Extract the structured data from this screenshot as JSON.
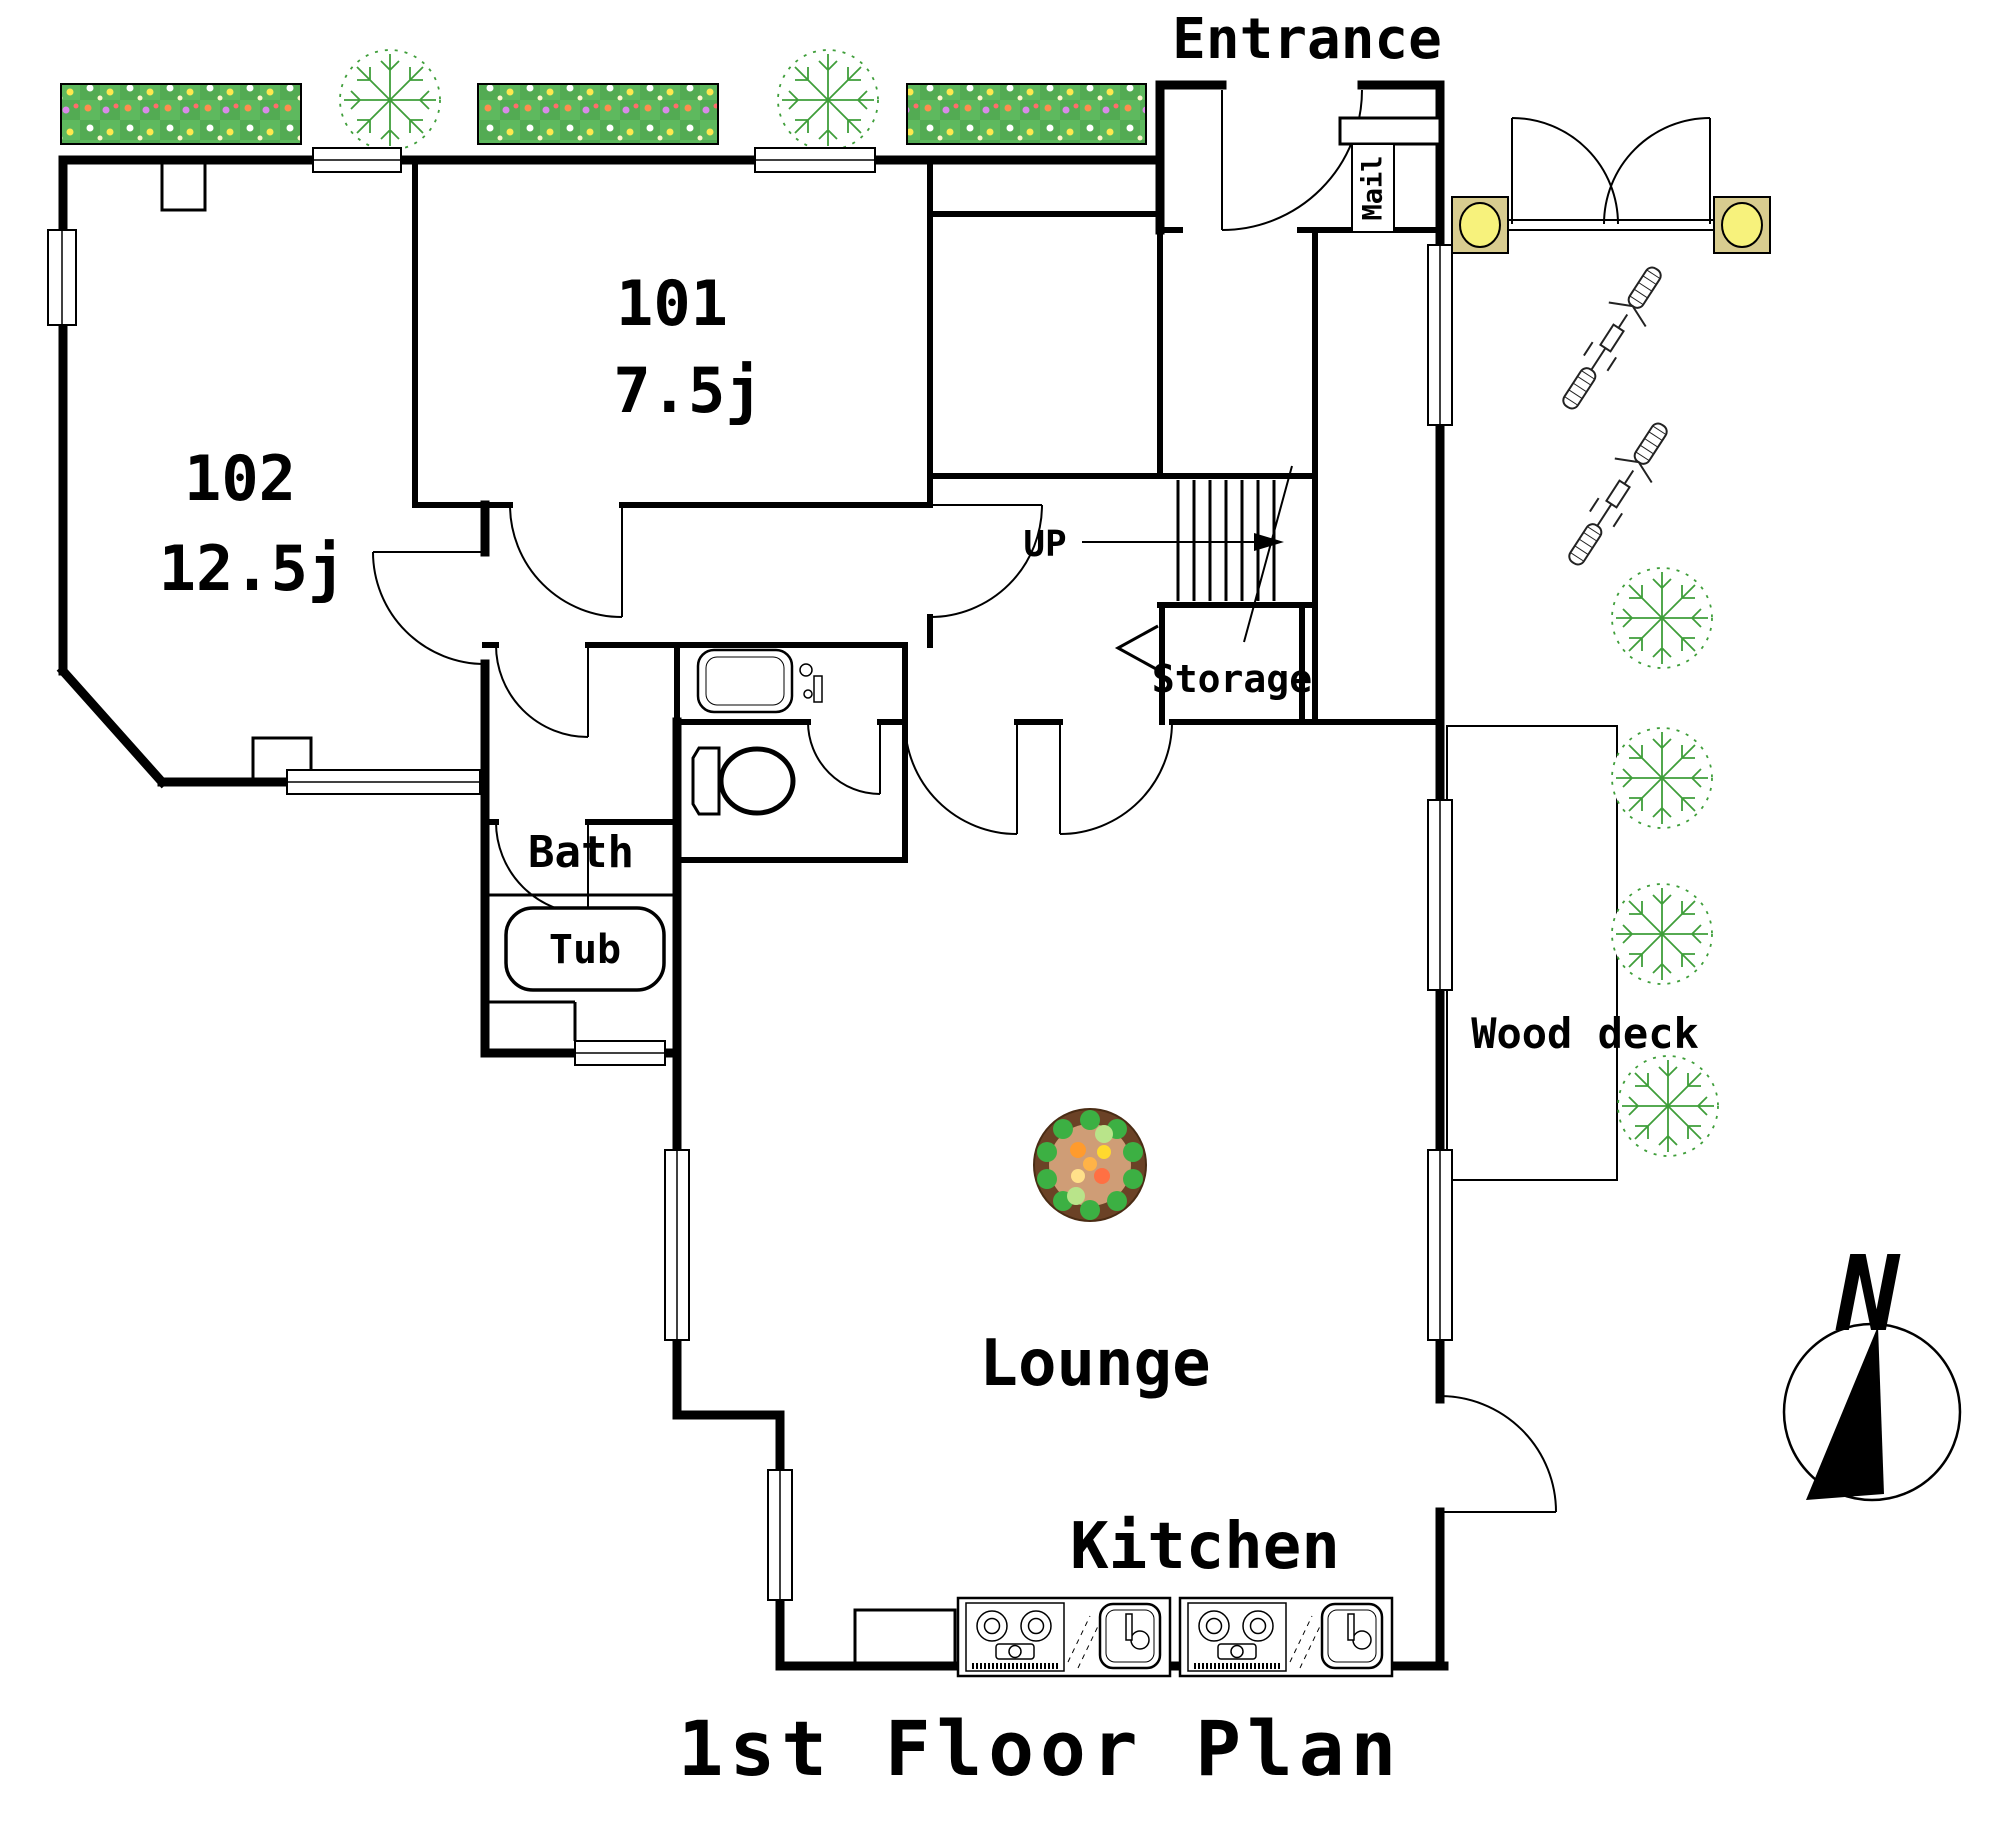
{
  "title": "1st Floor Plan",
  "compass": {
    "north_label": "N"
  },
  "labels": {
    "entrance": "Entrance",
    "mail": "Mail",
    "up": "UP",
    "storage": "Storage",
    "bath": "Bath",
    "tub": "Tub",
    "lounge": "Lounge",
    "kitchen": "Kitchen",
    "wood_deck": "Wood deck"
  },
  "rooms": {
    "r101": {
      "number": "101",
      "area": "7.5j"
    },
    "r102": {
      "number": "102",
      "area": "12.5j"
    }
  },
  "colors": {
    "flower_bed_green": "#5eb95e",
    "flower_bed_dark": "#4fa54f",
    "gate_pillar_tan": "#d8cc8f",
    "gate_lamp_yellow": "#f7f27c",
    "planter_rim_brown": "#6b4226",
    "planter_soil": "#cf9d76",
    "planter_leaf_green": "#3cb043",
    "tree_green": "#3f9e3a",
    "wall_black": "#000000"
  }
}
